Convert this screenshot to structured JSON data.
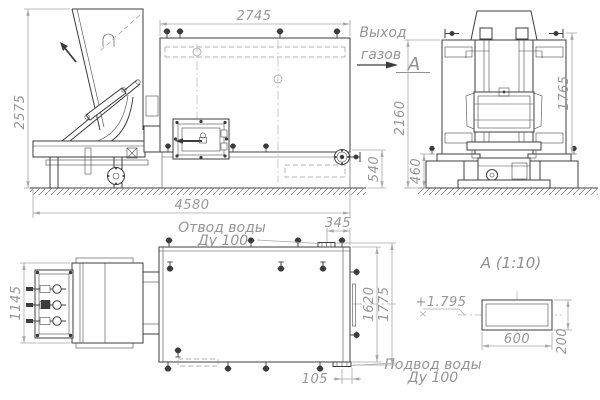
{
  "colors": {
    "line": "#3c3c3c",
    "dim_line": "#a8a8a8",
    "dim_text": "#979797",
    "background": "#ffffff"
  },
  "side_view": {
    "dim_width_top": "2745",
    "dim_height_left": "2575",
    "dim_length_bottom": "4580",
    "dim_outlet_height": "540",
    "gas_outlet_label_line1": "Выход",
    "gas_outlet_label_line2": "газов",
    "section_mark": "А"
  },
  "end_view": {
    "dim_total_height": "2160",
    "dim_foundation_height": "460",
    "dim_frame_height": "1765"
  },
  "plan_view": {
    "dim_feeder_width": "1145",
    "dim_outlet_offset": "345",
    "dim_body_width": "1620",
    "dim_overall_width": "1775",
    "dim_inlet_offset": "105",
    "water_outlet_label_line1": "Отвод воды",
    "water_outlet_label_line2": "Ду 100",
    "water_inlet_label_line1": "Подвод воды",
    "water_inlet_label_line2": "Ду 100"
  },
  "detail_view": {
    "title": "А  (1:10)",
    "level_mark": "+1.795",
    "dim_width": "600",
    "dim_height": "200"
  }
}
